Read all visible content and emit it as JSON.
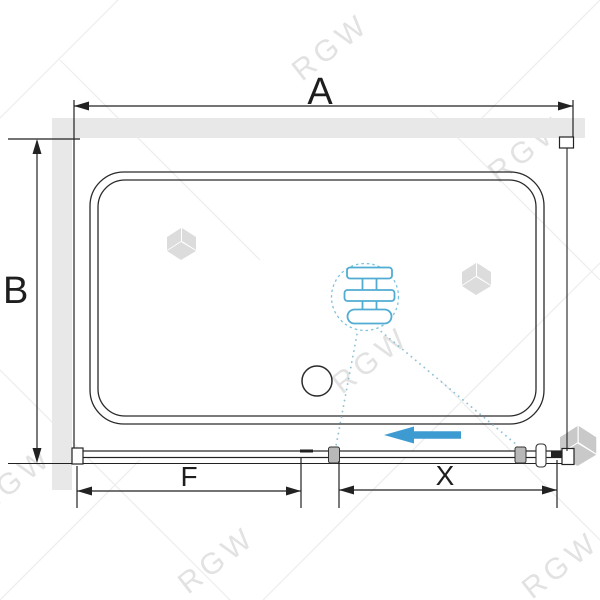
{
  "diagram": {
    "type": "technical-drawing-plan-view",
    "dimensions": {
      "overall_width_label": "A",
      "depth_label": "B",
      "fixed_panel_label": "F",
      "door_panel_label": "X"
    },
    "watermark_text": "RGW",
    "colors": {
      "wall_fill": "#e8e8e8",
      "line": "#222222",
      "accent_blue": "#3e9bd2",
      "detail_blue": "#50acd2",
      "leader_dots": "#90c2d4",
      "watermark": "#e2e2e2"
    },
    "icons": {
      "slide_direction": "arrow-left-icon",
      "detail_callout": "roller-assembly-icon",
      "watermark_logo": "rgw-cube-icon"
    }
  }
}
